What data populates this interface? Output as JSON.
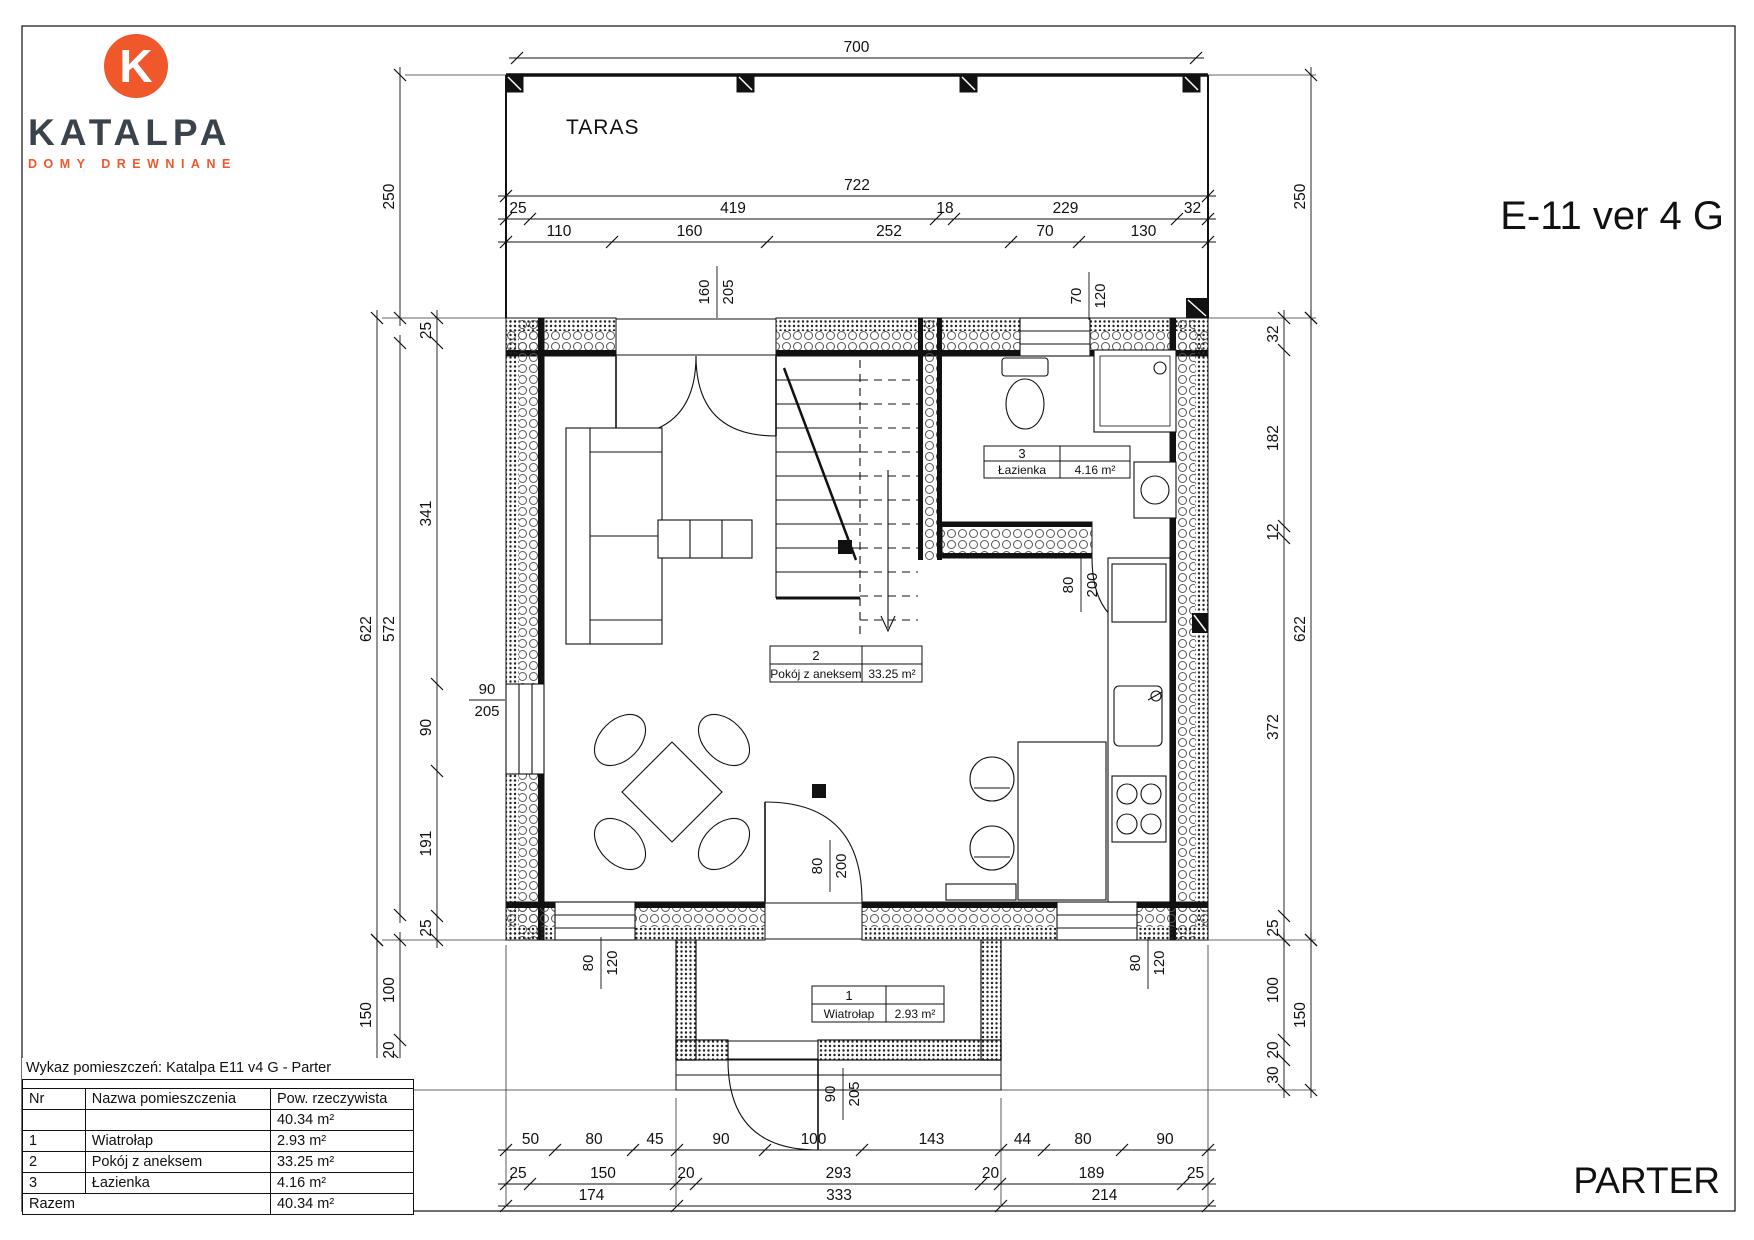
{
  "palette": {
    "accent": "#f0572b",
    "logo_dark": "#3a424b",
    "ink": "#111111"
  },
  "logo": {
    "mark": "K",
    "name": "KATALPA",
    "tagline": "DOMY DREWNIANE"
  },
  "header": {
    "model": "E-11 ver 4 G"
  },
  "footer": {
    "floor": "PARTER"
  },
  "plan": {
    "terrace": "TARAS",
    "room_tags": [
      {
        "nr": "1",
        "name": "Wiatrołap",
        "area": "2.93 m²"
      },
      {
        "nr": "2",
        "name": "Pokój z aneksem",
        "area": "33.25 m²"
      },
      {
        "nr": "3",
        "name": "Łazienka",
        "area": "4.16 m²"
      }
    ],
    "openings": {
      "entry_top": {
        "w": "160",
        "h": "205"
      },
      "bath_window": {
        "w": "70",
        "h": "120"
      },
      "left_window": {
        "w": "90",
        "h": "205"
      },
      "bath_door": {
        "w": "80",
        "h": "200"
      },
      "hall_door": {
        "w": "80",
        "h": "200"
      },
      "window_bl": {
        "w": "80",
        "h": "120"
      },
      "window_br": {
        "w": "80",
        "h": "120"
      },
      "front_door": {
        "w": "90",
        "h": "205"
      }
    }
  },
  "dims": {
    "top": {
      "d700": "700",
      "d722": "722",
      "chain1": [
        "25",
        "419",
        "18",
        "229",
        "32"
      ],
      "chain2": [
        "110",
        "160",
        "252",
        "70",
        "130"
      ]
    },
    "left": {
      "d250": "250",
      "d622": "622",
      "d572": "572",
      "chain": [
        "25",
        "341",
        "90",
        "191",
        "25"
      ],
      "bottom": [
        "100",
        "20",
        "30"
      ],
      "d150": "150"
    },
    "right": {
      "d250": "250",
      "d622": "622",
      "chain": [
        "32",
        "182",
        "12",
        "372",
        "25"
      ],
      "bottom": [
        "100",
        "20",
        "30"
      ],
      "d150": "150"
    },
    "bottom": {
      "chainA": [
        "50",
        "80",
        "45",
        "90",
        "100",
        "143",
        "44",
        "80",
        "90"
      ],
      "chainB": [
        "25",
        "150",
        "20",
        "293",
        "20",
        "189",
        "25"
      ],
      "chainC": [
        "174",
        "333",
        "214"
      ]
    }
  },
  "table": {
    "caption": "Wykaz pomieszczeń: Katalpa E11 v4 G - Parter",
    "headers": [
      "Nr",
      "Nazwa pomieszczenia",
      "Pow. rzeczywista"
    ],
    "subtotal": "40.34 m²",
    "rows": [
      {
        "nr": "1",
        "name": "Wiatrołap",
        "area": "2.93 m²"
      },
      {
        "nr": "2",
        "name": "Pokój z aneksem",
        "area": "33.25 m²"
      },
      {
        "nr": "3",
        "name": "Łazienka",
        "area": "4.16 m²"
      }
    ],
    "total_label": "Razem",
    "total_value": "40.34 m²"
  }
}
